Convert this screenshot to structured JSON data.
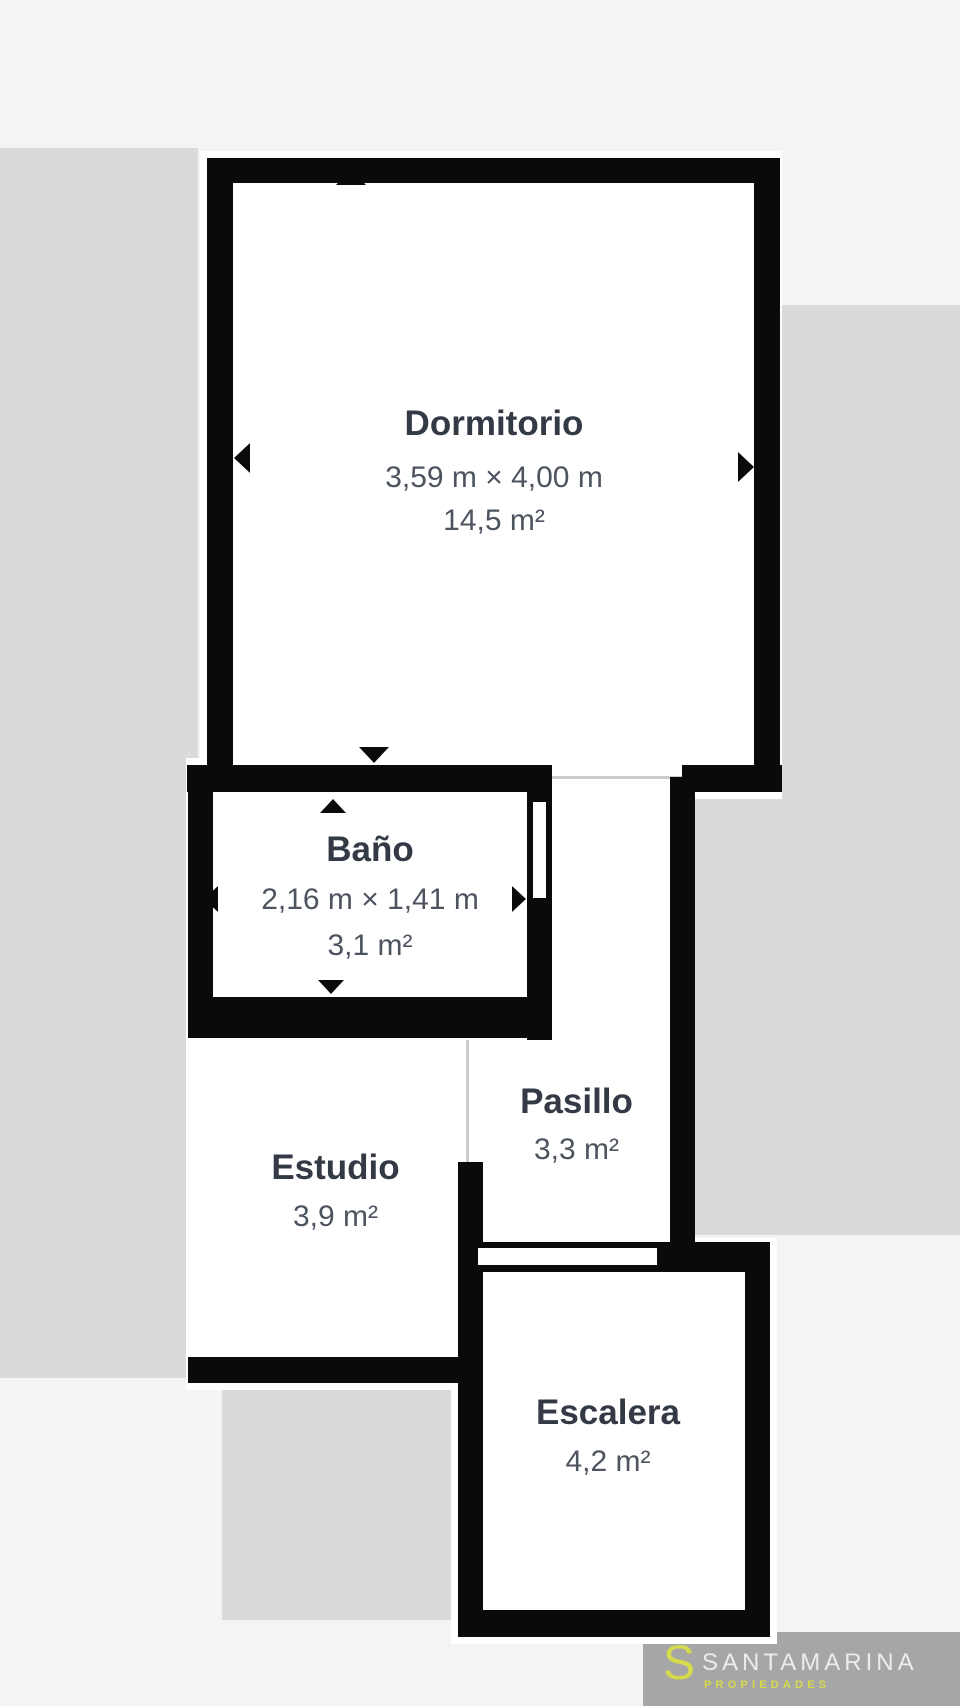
{
  "page": {
    "background_color": "#f3f4f4",
    "backdrop_color": "#d9dadb"
  },
  "floorplan": {
    "wall_color": "#0a0a0a",
    "room_color": "#ffffff",
    "title_color": "#343a45",
    "subtext_color": "#4d5460",
    "rooms": [
      {
        "name": "Dormitorio",
        "dimensions": "3,59 m × 4,00 m",
        "area": "14,5 m²"
      },
      {
        "name": "Baño",
        "dimensions": "2,16 m × 1,41 m",
        "area": "3,1 m²"
      },
      {
        "name": "Pasillo",
        "area": "3,3 m²"
      },
      {
        "name": "Estudio",
        "area": "3,9 m²"
      },
      {
        "name": "Escalera",
        "area": "4,2 m²"
      }
    ]
  },
  "branding": {
    "initial": "S",
    "company": "SANTAMARINA",
    "tagline": "PROPIEDADES",
    "accent_color": "#d6db4c",
    "text_color": "#ececec",
    "background_color": "#a6a6a6"
  }
}
